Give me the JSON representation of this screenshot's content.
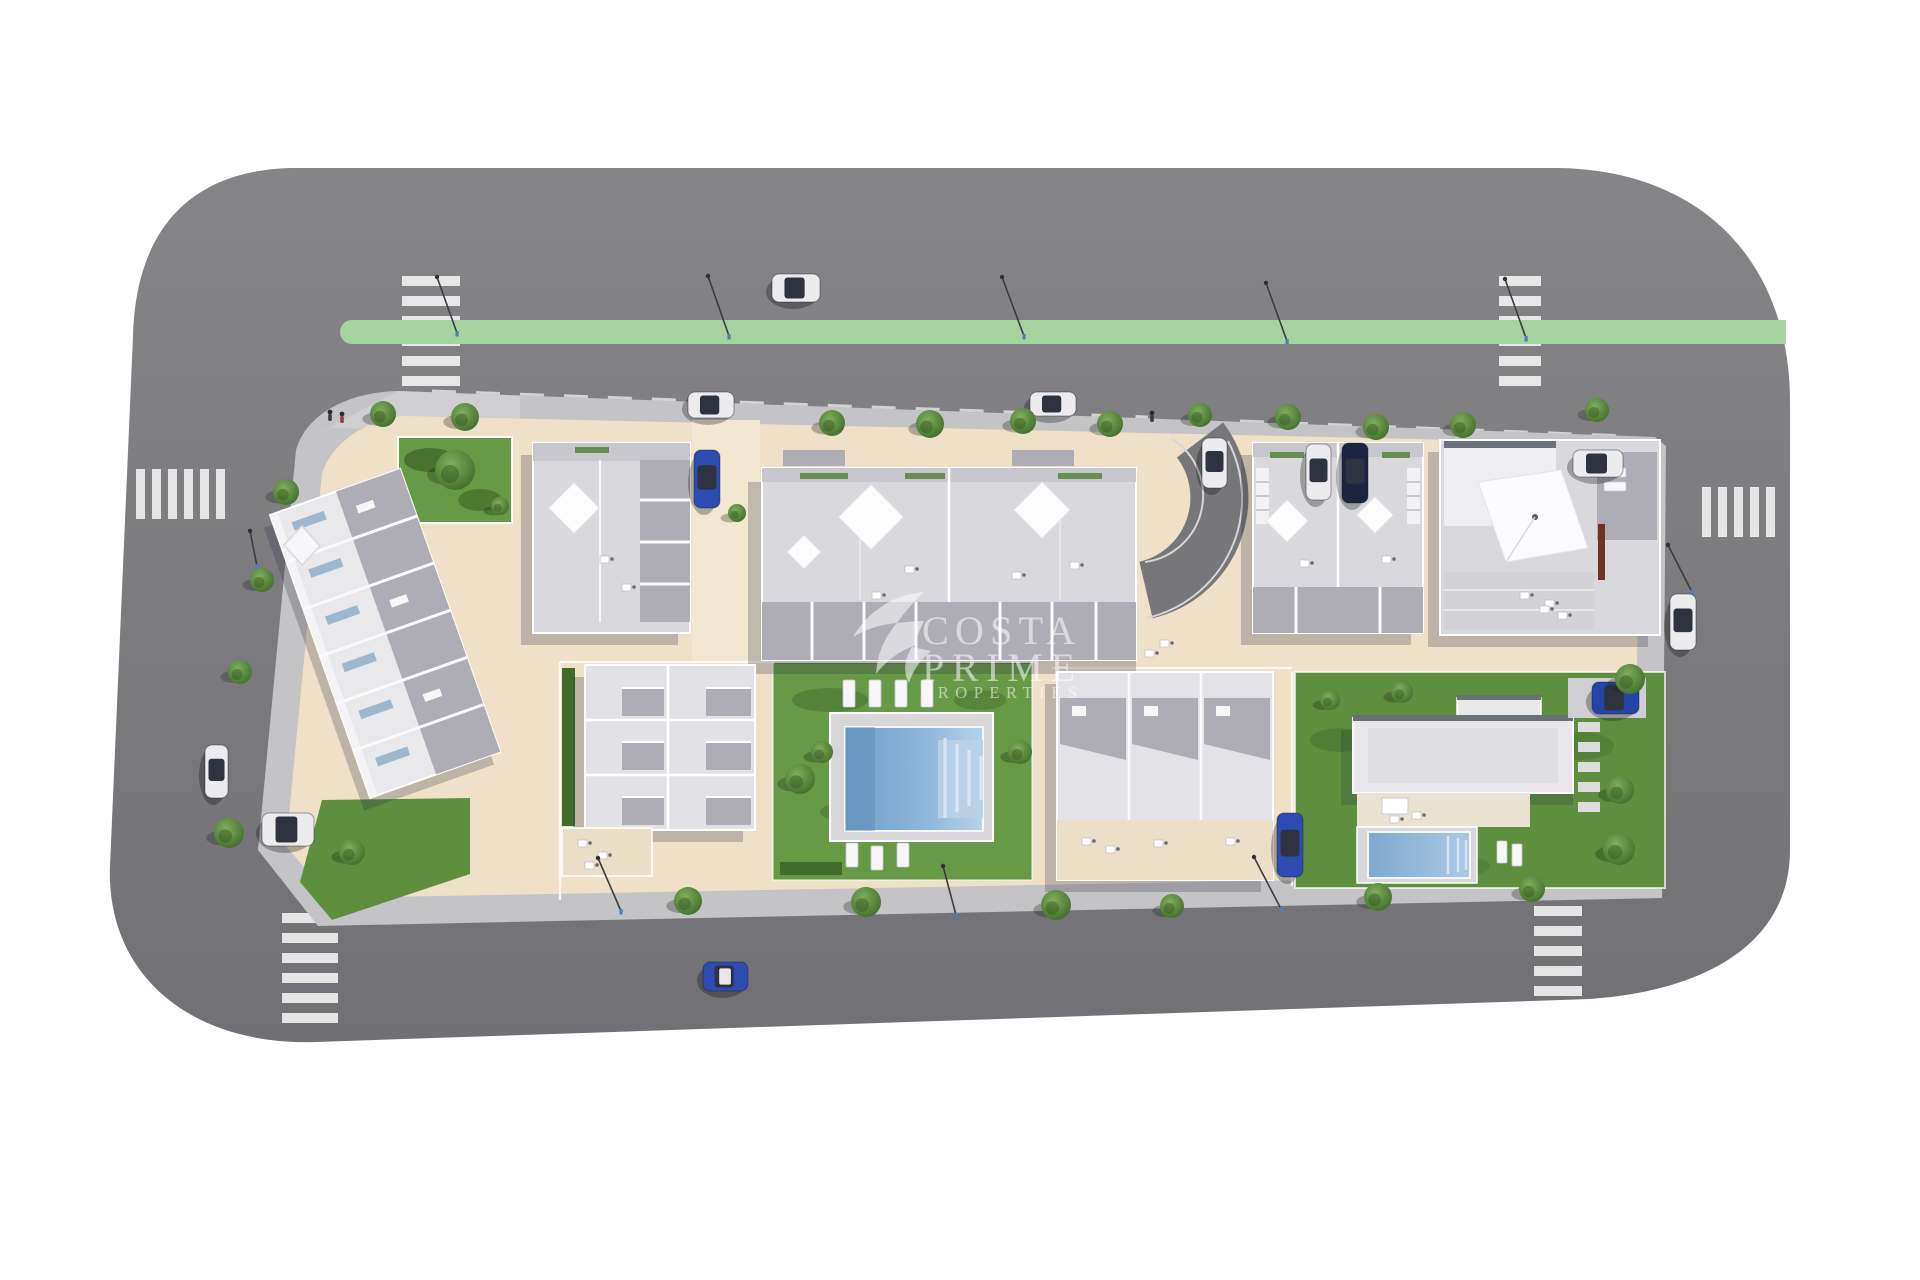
{
  "watermark": {
    "logo": "swallow-bird-icon",
    "line1": "COSTA",
    "line2": "PRIME",
    "line3": "PROPERTIES",
    "color": "#ffffff",
    "opacity": 0.55
  },
  "palette": {
    "road": "#7d7d80",
    "roadLight": "#87878a",
    "roadDark": "#6f6f74",
    "greenStrip": "#a7d3a0",
    "sidewalk": "#c4c3c6",
    "plot": "#eee1c8",
    "plotLight": "#f2e8d2",
    "grass": "#679a47",
    "grassDark": "#46702f",
    "hedge": "#3f6c2b",
    "lawn": "#5d8f3f",
    "roofLight": "#d9d9dd",
    "roofWhite": "#e9e9ec",
    "terrace": "#aeadb6",
    "canopy": "#8f8f98",
    "poolDeep": "#6f9cc6",
    "poolLight": "#9ec4e6",
    "poolSteps": "#b9d2e8",
    "stripe": "#f5f5f5",
    "lamp": "#4a7fb5",
    "chimney": "#6e3327",
    "carWhite": "#ececee",
    "carBlue": "#2d4cb3",
    "carNavy": "#1d2440",
    "glass": "#2f3340",
    "treeMain": "#6f9e4e",
    "treeDark": "#3e6a2a",
    "watermark": "#ffffff"
  },
  "scene": {
    "crosswalks": [
      {
        "x": 402,
        "y": 276,
        "w": 58,
        "h": 110,
        "dir": "v"
      },
      {
        "x": 1499,
        "y": 276,
        "w": 42,
        "h": 110,
        "dir": "v"
      },
      {
        "x": 136,
        "y": 469,
        "w": 102,
        "h": 50,
        "dir": "h"
      },
      {
        "x": 1702,
        "y": 487,
        "w": 86,
        "h": 50,
        "dir": "h"
      },
      {
        "x": 282,
        "y": 913,
        "w": 56,
        "h": 114,
        "dir": "v"
      },
      {
        "x": 1534,
        "y": 906,
        "w": 48,
        "h": 100,
        "dir": "v"
      }
    ],
    "cars": [
      {
        "name": "car-white-top-road",
        "x": 772,
        "y": 274,
        "w": 48,
        "h": 28,
        "body": "#ececee"
      },
      {
        "name": "car-white-parked-top-1",
        "x": 688,
        "y": 392,
        "w": 46,
        "h": 26,
        "body": "#ececee"
      },
      {
        "name": "car-white-parked-top-2",
        "x": 1030,
        "y": 392,
        "w": 46,
        "h": 24,
        "body": "#ececee"
      },
      {
        "name": "car-blue-driveway",
        "x": 694,
        "y": 450,
        "w": 26,
        "h": 58,
        "body": "#2d4cb3"
      },
      {
        "name": "car-white-curve",
        "x": 1202,
        "y": 438,
        "w": 25,
        "h": 50,
        "body": "#ececee"
      },
      {
        "name": "car-white-b4",
        "x": 1306,
        "y": 444,
        "w": 25,
        "h": 56,
        "body": "#ececee"
      },
      {
        "name": "car-navy-b4",
        "x": 1342,
        "y": 443,
        "w": 26,
        "h": 60,
        "body": "#1d2440"
      },
      {
        "name": "car-white-b5",
        "x": 1573,
        "y": 450,
        "w": 50,
        "h": 27,
        "body": "#ececee"
      },
      {
        "name": "car-white-left-road",
        "x": 205,
        "y": 745,
        "w": 23,
        "h": 53,
        "body": "#ececee"
      },
      {
        "name": "car-white-parked-left",
        "x": 262,
        "y": 813,
        "w": 52,
        "h": 33,
        "body": "#ececee"
      },
      {
        "name": "car-blue-bottom-road",
        "x": 703,
        "y": 962,
        "w": 45,
        "h": 29,
        "body": "#2d4cb3",
        "roof": "#e8e8ea"
      },
      {
        "name": "car-blue-blockb",
        "x": 1277,
        "y": 813,
        "w": 26,
        "h": 64,
        "body": "#2d4cb3"
      },
      {
        "name": "car-blue-villa",
        "x": 1592,
        "y": 682,
        "w": 47,
        "h": 32,
        "body": "#2544a8"
      },
      {
        "name": "car-white-right-road",
        "x": 1670,
        "y": 594,
        "w": 26,
        "h": 56,
        "body": "#ececee"
      }
    ],
    "trees": [
      {
        "x": 383,
        "y": 414,
        "r": 13
      },
      {
        "x": 465,
        "y": 417,
        "r": 14
      },
      {
        "x": 832,
        "y": 423,
        "r": 13
      },
      {
        "x": 930,
        "y": 424,
        "r": 14
      },
      {
        "x": 1023,
        "y": 421,
        "r": 13
      },
      {
        "x": 1110,
        "y": 424,
        "r": 13
      },
      {
        "x": 1200,
        "y": 415,
        "r": 12
      },
      {
        "x": 1288,
        "y": 417,
        "r": 13
      },
      {
        "x": 1376,
        "y": 427,
        "r": 13
      },
      {
        "x": 1463,
        "y": 425,
        "r": 13
      },
      {
        "x": 1597,
        "y": 410,
        "r": 12
      },
      {
        "x": 286,
        "y": 492,
        "r": 13
      },
      {
        "x": 262,
        "y": 580,
        "r": 12
      },
      {
        "x": 240,
        "y": 672,
        "r": 12
      },
      {
        "x": 229,
        "y": 833,
        "r": 15
      },
      {
        "x": 688,
        "y": 901,
        "r": 14
      },
      {
        "x": 866,
        "y": 902,
        "r": 15
      },
      {
        "x": 1056,
        "y": 905,
        "r": 15
      },
      {
        "x": 1172,
        "y": 906,
        "r": 12
      },
      {
        "x": 1378,
        "y": 897,
        "r": 14
      },
      {
        "x": 1532,
        "y": 889,
        "r": 13
      },
      {
        "x": 1630,
        "y": 679,
        "r": 15
      },
      {
        "x": 1619,
        "y": 849,
        "r": 16
      },
      {
        "x": 455,
        "y": 470,
        "r": 20
      },
      {
        "x": 500,
        "y": 506,
        "r": 9
      },
      {
        "x": 737,
        "y": 513,
        "r": 9
      },
      {
        "x": 800,
        "y": 779,
        "r": 15
      },
      {
        "x": 822,
        "y": 752,
        "r": 11
      },
      {
        "x": 1020,
        "y": 752,
        "r": 12
      },
      {
        "x": 1402,
        "y": 692,
        "r": 11
      },
      {
        "x": 1620,
        "y": 790,
        "r": 14
      },
      {
        "x": 1330,
        "y": 700,
        "r": 10
      },
      {
        "x": 352,
        "y": 852,
        "r": 13
      }
    ],
    "lamps": [
      {
        "x1": 437,
        "y1": 277,
        "x2": 457,
        "y2": 333
      },
      {
        "x1": 708,
        "y1": 276,
        "x2": 729,
        "y2": 336
      },
      {
        "x1": 1002,
        "y1": 277,
        "x2": 1024,
        "y2": 336
      },
      {
        "x1": 1266,
        "y1": 283,
        "x2": 1287,
        "y2": 341
      },
      {
        "x1": 1505,
        "y1": 279,
        "x2": 1526,
        "y2": 338
      },
      {
        "x1": 598,
        "y1": 858,
        "x2": 621,
        "y2": 911
      },
      {
        "x1": 943,
        "y1": 866,
        "x2": 956,
        "y2": 915
      },
      {
        "x1": 1254,
        "y1": 857,
        "x2": 1281,
        "y2": 909
      },
      {
        "x1": 1668,
        "y1": 545,
        "x2": 1692,
        "y2": 592
      },
      {
        "x1": 250,
        "y1": 531,
        "x2": 257,
        "y2": 566
      }
    ],
    "loungers": [
      {
        "x": 843,
        "y": 680,
        "w": 12,
        "h": 27
      },
      {
        "x": 869,
        "y": 680,
        "w": 12,
        "h": 27
      },
      {
        "x": 895,
        "y": 680,
        "w": 12,
        "h": 27
      },
      {
        "x": 921,
        "y": 680,
        "w": 12,
        "h": 27
      },
      {
        "x": 846,
        "y": 843,
        "w": 12,
        "h": 24
      },
      {
        "x": 871,
        "y": 846,
        "w": 12,
        "h": 24
      },
      {
        "x": 897,
        "y": 843,
        "w": 12,
        "h": 24
      },
      {
        "x": 1497,
        "y": 841,
        "w": 10,
        "h": 22
      },
      {
        "x": 1512,
        "y": 844,
        "w": 10,
        "h": 22
      },
      {
        "x": 1604,
        "y": 468,
        "w": 22,
        "h": 9
      },
      {
        "x": 1604,
        "y": 482,
        "w": 22,
        "h": 9
      }
    ],
    "roof_items": [
      {
        "x": 600,
        "y": 556
      },
      {
        "x": 622,
        "y": 584
      },
      {
        "x": 905,
        "y": 566
      },
      {
        "x": 872,
        "y": 592
      },
      {
        "x": 1012,
        "y": 572
      },
      {
        "x": 1070,
        "y": 562
      },
      {
        "x": 1300,
        "y": 560
      },
      {
        "x": 1382,
        "y": 556
      },
      {
        "x": 1520,
        "y": 592
      },
      {
        "x": 1545,
        "y": 600
      },
      {
        "x": 1160,
        "y": 640
      },
      {
        "x": 1145,
        "y": 650
      },
      {
        "x": 1390,
        "y": 816
      },
      {
        "x": 1412,
        "y": 812
      },
      {
        "x": 578,
        "y": 840
      },
      {
        "x": 598,
        "y": 852
      },
      {
        "x": 585,
        "y": 862
      },
      {
        "x": 1082,
        "y": 838
      },
      {
        "x": 1106,
        "y": 846
      },
      {
        "x": 1154,
        "y": 840
      },
      {
        "x": 1226,
        "y": 838
      },
      {
        "x": 1540,
        "y": 606
      },
      {
        "x": 1558,
        "y": 612
      }
    ],
    "pedestrians": [
      {
        "x": 330,
        "y": 412,
        "c": "#3a3a40"
      },
      {
        "x": 342,
        "y": 414,
        "c": "#8a4040"
      },
      {
        "x": 1152,
        "y": 413,
        "c": "#3a3a40"
      }
    ]
  }
}
